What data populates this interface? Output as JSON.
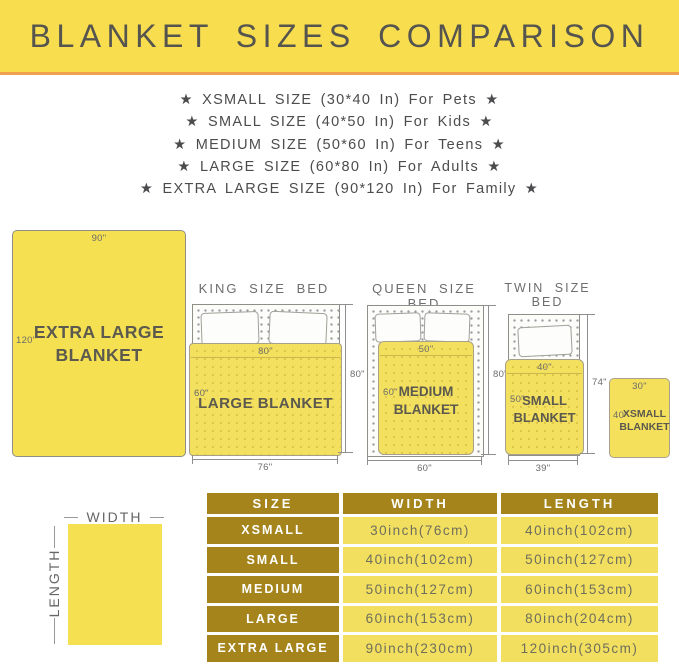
{
  "header": {
    "title": "BLANKET SIZES COMPARISON"
  },
  "size_list": [
    "★ XSMALL SIZE (30*40 In) For Pets ★",
    "★ SMALL SIZE (40*50 In) For Kids ★",
    "★ MEDIUM SIZE (50*60 In) For Teens ★",
    "★ LARGE SIZE (60*80 In) For Adults ★",
    "★ EXTRA LARGE SIZE (90*120 In) For Family ★"
  ],
  "diagrams": {
    "xl": {
      "top_label": "90\"",
      "side_label": "120\"",
      "line1": "EXTRA LARGE",
      "line2": "BLANKET"
    },
    "king": {
      "title": "KING SIZE BED",
      "top_label": "80\"",
      "side_label": "60\"",
      "name": "LARGE BLANKET",
      "height_label": "80\"",
      "width_label": "76\""
    },
    "queen": {
      "title": "QUEEN SIZE BED",
      "top_label": "50\"",
      "side_label": "60\"",
      "line1": "MEDIUM",
      "line2": "BLANKET",
      "height_label": "80\"",
      "width_label": "60\""
    },
    "twin": {
      "title": "TWIN SIZE BED",
      "top_label": "40\"",
      "side_label": "50\"",
      "line1": "SMALL",
      "line2": "BLANKET",
      "height_label": "74\"",
      "width_label": "39\""
    },
    "xsmall": {
      "top_label": "30\"",
      "side_label": "40\"",
      "line1": "XSMALL",
      "line2": "BLANKET"
    },
    "legend": {
      "width_label": "WIDTH",
      "length_label": "LENGTH"
    }
  },
  "table": {
    "headers": [
      "SIZE",
      "WIDTH",
      "LENGTH"
    ],
    "rows": [
      {
        "size": "XSMALL",
        "width": "30inch(76cm)",
        "length": "40inch(102cm)"
      },
      {
        "size": "SMALL",
        "width": "40inch(102cm)",
        "length": "50inch(127cm)"
      },
      {
        "size": "MEDIUM",
        "width": "50inch(127cm)",
        "length": "60inch(153cm)"
      },
      {
        "size": "LARGE",
        "width": "60inch(153cm)",
        "length": "80inch(204cm)"
      },
      {
        "size": "EXTRA LARGE",
        "width": "90inch(230cm)",
        "length": "120inch(305cm)"
      }
    ]
  },
  "colors": {
    "header_bg": "#F8DE4E",
    "header_rule": "#EEA14E",
    "blanket_yellow": "#F3E05E",
    "table_gold": "#A5841C",
    "table_cell_yellow": "#F2DF5F"
  }
}
